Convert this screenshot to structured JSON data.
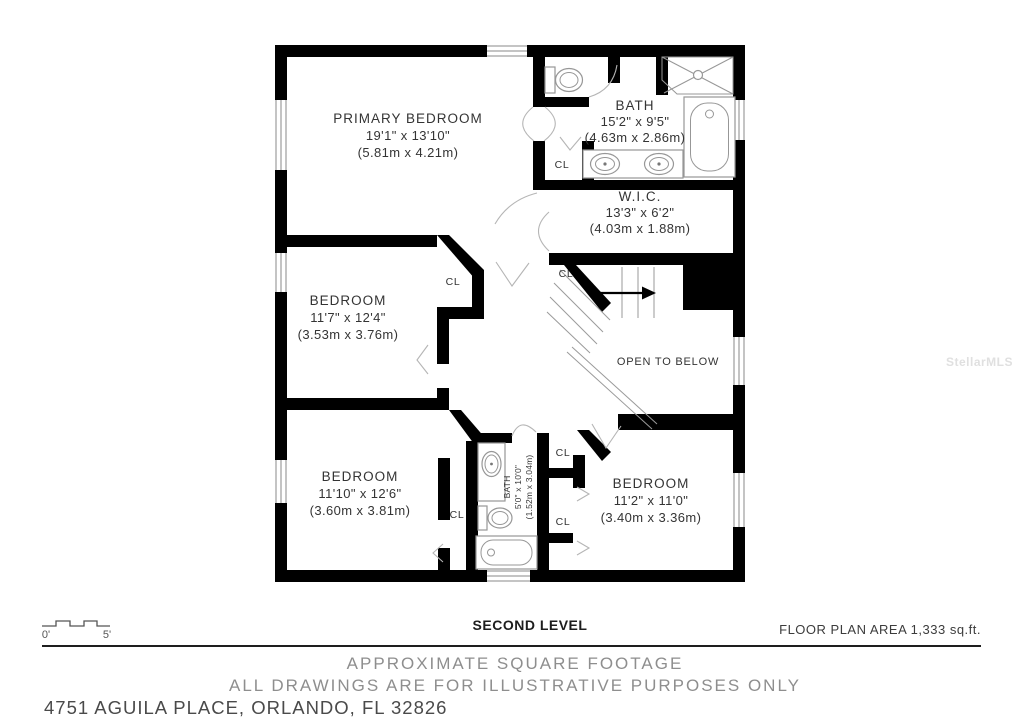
{
  "watermark": "StellarMLS",
  "plan": {
    "rooms": {
      "primary": {
        "name": "PRIMARY BEDROOM",
        "dims": "19'1\" x 13'10\"",
        "metric": "(5.81m x 4.21m)"
      },
      "bath_main": {
        "name": "BATH",
        "dims": "15'2\" x 9'5\"",
        "metric": "(4.63m x 2.86m)"
      },
      "wic": {
        "name": "W.I.C.",
        "dims": "13'3\" x 6'2\"",
        "metric": "(4.03m x 1.88m)"
      },
      "bedroom_mid": {
        "name": "BEDROOM",
        "dims": "11'7\" x 12'4\"",
        "metric": "(3.53m x 3.76m)"
      },
      "bedroom_bl": {
        "name": "BEDROOM",
        "dims": "11'10\" x 12'6\"",
        "metric": "(3.60m x 3.81m)"
      },
      "bath_small": {
        "name": "BATH",
        "dims": "5'0\" x 10'0\"",
        "metric": "(1.52m x 3.04m)"
      },
      "bedroom_br": {
        "name": "BEDROOM",
        "dims": "11'2\" x 11'0\"",
        "metric": "(3.40m x 3.36m)"
      },
      "open_below": {
        "name": "OPEN TO BELOW"
      }
    },
    "closet_label": "CL",
    "colors": {
      "wall": "#000000",
      "fixture_line": "#979797",
      "watermark": "#e0e0e0"
    }
  },
  "footer": {
    "scale_start": "0'",
    "scale_end": "5'",
    "level": "SECOND LEVEL",
    "area": "FLOOR PLAN AREA 1,333 sq.ft.",
    "disclaimer1": "APPROXIMATE SQUARE FOOTAGE",
    "disclaimer2": "ALL DRAWINGS ARE FOR ILLUSTRATIVE PURPOSES ONLY",
    "address": "4751 AGUILA PLACE, ORLANDO, FL 32826"
  }
}
